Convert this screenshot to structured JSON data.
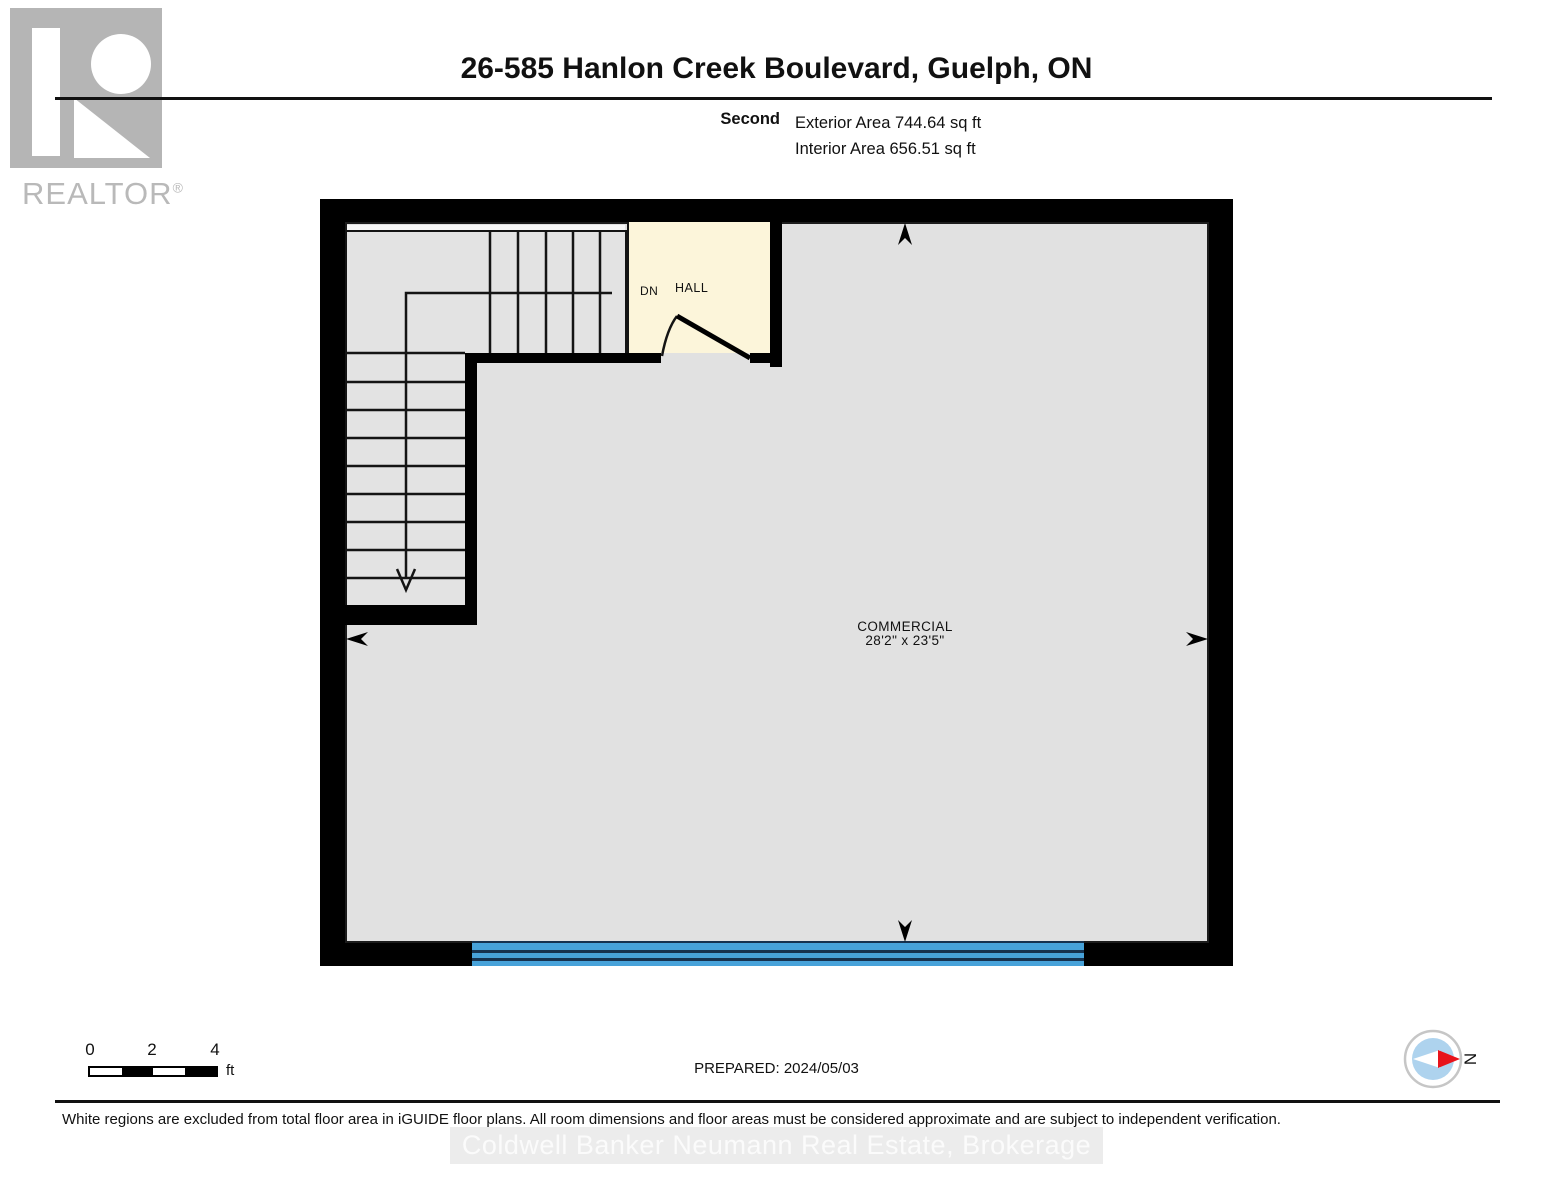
{
  "header": {
    "logo_word": "REALTOR",
    "logo_reg": "®",
    "title": "26-585 Hanlon Creek Boulevard, Guelph, ON",
    "floor_label": "Second",
    "exterior_area": "Exterior Area 744.64 sq ft",
    "interior_area": "Interior Area 656.51 sq ft"
  },
  "plan": {
    "commercial": {
      "name": "COMMERCIAL",
      "dimensions": "28'2\" x 23'5\""
    },
    "hall_label": "HALL",
    "stairs_direction_label": "DN",
    "colors": {
      "wall": "#000000",
      "floor": "#e1e1e1",
      "stairs": "#e3e3e3",
      "hall": "#fcf5da",
      "window": "#47a2d9"
    }
  },
  "footer": {
    "scale": {
      "tick0": "0",
      "tick2": "2",
      "tick4": "4",
      "unit": "ft"
    },
    "prepared": "PREPARED: 2024/05/03",
    "compass_label": "N",
    "disclaimer": "White regions are excluded from total floor area in iGUIDE floor plans. All room dimensions and floor areas must be considered approximate and are subject to independent verification.",
    "watermark": "Coldwell Banker Neumann Real Estate, Brokerage"
  }
}
